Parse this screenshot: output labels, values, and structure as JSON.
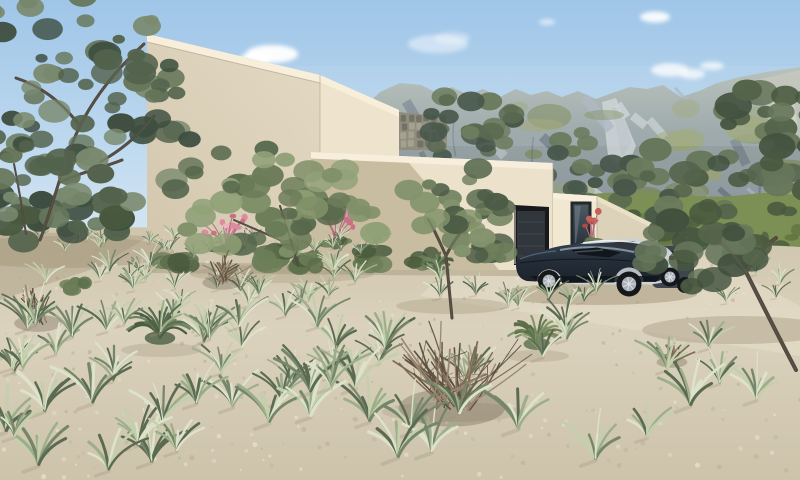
{
  "meta": {
    "type": "architectural-exterior-rendering",
    "description": "3D visualization of a modern flat-roofed beige villa on a sandy hillside with dry grasses, olive trees, two parked cars and a rocky green mountain range under a light blue sky",
    "width": 800,
    "height": 480
  },
  "palette": {
    "sky_top": "#9fc5e8",
    "sky_mid": "#bcd8ee",
    "sky_horizon": "#d9e8f4",
    "cloud": "#ffffff",
    "mtn_crest": "#b5bdb4",
    "mtn_upper": "#95a1a1",
    "mtn_base": "#87939e",
    "mtn_rock_light": "#aab3bd",
    "mtn_rock_bright": "#cdd2d3",
    "mtn_rock_shadow": "#65727f",
    "mtn_green": "#9aa26b",
    "mtn_green_dark": "#77854e",
    "foothill": "#7c8f55",
    "foothill_dark": "#5f7240",
    "scrub_dark": "#4b5e3f",
    "wall_bright": "#f1e8d2",
    "wall_lit": "#eee4ce",
    "wall_mid": "#ece2cb",
    "wall_shaded": "#c9bda1",
    "coping_light": "#f7efdc",
    "edge_dark": "#baac8e",
    "stone_base": "#8f8d7d",
    "stone_light": "#a8a594",
    "stone_dark": "#6f6d60",
    "garage_recess": "#17191c",
    "garage_door": "#30363b",
    "door_line": "#3f464c",
    "window_frame": "#24282b",
    "glass_top": "#4d5a64",
    "glass_bottom": "#2b333b",
    "glass_refl": "#72828e",
    "sand_top": "#cfc5ad",
    "sand_mid": "#dbd2bd",
    "sand_bottom": "#cdc3ab",
    "sand_speck_dark": "#bfb49a",
    "sand_speck_light": "#e9e0cb",
    "driveway_light": "#e7dfca",
    "shadow_ground": "#a1947a",
    "trunk_dark": "#4b443b",
    "trunk_light": "#6b6254",
    "twig": "#7d6c55",
    "twig_light": "#998771",
    "twig_dark": "#5e5243",
    "flower_pink": "#dc8ba0",
    "flower_pink_light": "#edb3c2",
    "flower_pink_deep": "#c96f86",
    "flower_stem": "#b2717f",
    "flower_red": "#b04a42",
    "car_navy_top": "#323f4d",
    "car_navy": "#242d38",
    "car_navy_dark": "#1b222b",
    "car_roof_hi": "#93a1ad",
    "car_glass": "#12171d",
    "sedan_silver": "#cdd2d6",
    "sedan_shade": "#a8aeb3",
    "sedan_glass": "#30373e",
    "sedan_hi": "#f1f4f6",
    "suv_dark": "#3e454c",
    "suv_glass": "#262c31",
    "tire": "#14181b",
    "rim": "#a9b0b7",
    "rim_hi": "#d9dee2",
    "taillight": "#8f4746"
  },
  "scene": {
    "sky": {
      "name": "clear-morning-sky"
    },
    "mountains": {
      "name": "rocky-green-mountain-range"
    },
    "house": {
      "style": "modern-minimalist-stacked-cubes",
      "volumes": [
        "tall-volume",
        "middle-volume",
        "garage-wing"
      ],
      "features": [
        "flat-parapet-roofs",
        "recessed-garage",
        "tall-narrow-window",
        "stone-garden-wall"
      ]
    },
    "vehicles": [
      {
        "name": "dark-blue-coupe"
      },
      {
        "name": "silver-sedan"
      },
      {
        "name": "dark-suv-rear"
      }
    ],
    "landscape": [
      "olive-trees",
      "dry-grass-tufts",
      "pink-flowering-plants",
      "dry-twig-bushes",
      "sand-gravel-ground"
    ]
  },
  "generated": {
    "stones": {
      "x0": 400,
      "y0": 114,
      "w": 46,
      "h": 34,
      "rows": 4,
      "cols": 6
    },
    "mountain": {
      "streaks": 30,
      "greens": 34,
      "ravines": 9,
      "x": [
        262,
        800
      ],
      "ystreak": [
        86,
        192
      ],
      "ygreen": [
        104,
        238
      ]
    },
    "foothill_scrub": {
      "count": 44,
      "x": [
        300,
        800
      ],
      "y": [
        210,
        248
      ]
    },
    "sand_speckles": 280,
    "shrubs": [
      {
        "cx": 175,
        "cy": 262,
        "rx": 20,
        "ry": 12
      },
      {
        "cx": 270,
        "cy": 258,
        "rx": 24,
        "ry": 14
      },
      {
        "cx": 308,
        "cy": 262,
        "rx": 17,
        "ry": 11
      },
      {
        "cx": 372,
        "cy": 258,
        "rx": 20,
        "ry": 12
      },
      {
        "cx": 424,
        "cy": 258,
        "rx": 15,
        "ry": 10
      },
      {
        "cx": 492,
        "cy": 254,
        "rx": 12,
        "ry": 8
      },
      {
        "cx": 78,
        "cy": 286,
        "rx": 14,
        "ry": 9
      }
    ],
    "shrub_colors": [
      "#5a6d4a",
      "#6c7f58",
      "#4a5b3e"
    ],
    "trees": [
      {
        "name": "shrub-band-left",
        "layer": "main",
        "clumps": 26,
        "rMin": 8,
        "rMax": 18,
        "colors": [
          "#3e4e40",
          "#52624c",
          "#66765a",
          "#49593f"
        ],
        "blobs": [
          {
            "cx": 58,
            "cy": 216,
            "rx": 88,
            "ry": 30
          }
        ],
        "branches": [],
        "branchWidth": 2
      },
      {
        "name": "olive-tree-left-edge",
        "layer": "main",
        "clumps": 20,
        "rMin": 7,
        "rMax": 15,
        "colors": [
          "#3e4e40",
          "#52624c",
          "#66765a",
          "#7a8a6e"
        ],
        "blobs": [
          {
            "cx": 14,
            "cy": 160,
            "rx": 48,
            "ry": 78
          }
        ],
        "branches": [
          "M26,234 C22,206 18,184 14,164"
        ],
        "branchWidth": 2
      },
      {
        "name": "olive-tree-top-left",
        "layer": "main",
        "clumps": 72,
        "rMin": 6,
        "rMax": 17,
        "colors": [
          "#3e4e40",
          "#52624c",
          "#66765a",
          "#7a8a6e"
        ],
        "blobs": [
          {
            "cx": 60,
            "cy": 70,
            "rx": 115,
            "ry": 100
          },
          {
            "cx": 125,
            "cy": 130,
            "rx": 75,
            "ry": 85
          }
        ],
        "branches": [
          "M40,240 C55,200 64,158 80,126",
          "M80,126 C96,94 120,66 144,44",
          "M80,126 C60,100 40,86 16,78",
          "M100,162 C122,150 140,134 154,116",
          "M60,182 C82,172 102,168 122,160"
        ],
        "branchWidth": 3
      },
      {
        "name": "olive-tree-center",
        "layer": "main",
        "clumps": 48,
        "rMin": 8,
        "rMax": 17,
        "colors": [
          "#57684c",
          "#6b7c59",
          "#7f9068",
          "#91a178"
        ],
        "blobs": [
          {
            "cx": 272,
            "cy": 188,
            "rx": 95,
            "ry": 48
          },
          {
            "cx": 248,
            "cy": 224,
            "rx": 68,
            "ry": 42
          },
          {
            "cx": 332,
            "cy": 214,
            "rx": 52,
            "ry": 42
          }
        ],
        "branches": [
          "M298,266 C292,244 286,224 280,206",
          "M280,240 C262,232 248,226 234,220"
        ],
        "branchWidth": 2
      },
      {
        "name": "olive-tree-garage",
        "layer": "main",
        "clumps": 36,
        "rMin": 7,
        "rMax": 15,
        "colors": [
          "#5a6b4f",
          "#6e7f5c",
          "#82936c",
          "#4c5c46"
        ],
        "blobs": [
          {
            "cx": 456,
            "cy": 202,
            "rx": 54,
            "ry": 40
          },
          {
            "cx": 482,
            "cy": 232,
            "rx": 36,
            "ry": 28
          }
        ],
        "branches": [
          "M452,318 C450,296 448,276 446,256",
          "M446,256 C439,240 434,229 428,219",
          "M446,256 C453,241 461,231 470,222"
        ],
        "branchWidth": 3
      },
      {
        "name": "olive-canopy-behind-parapet",
        "layer": "bg",
        "clumps": 26,
        "rMin": 7,
        "rMax": 15,
        "colors": [
          "#46564a",
          "#5a6a52",
          "#6c7c5e"
        ],
        "blobs": [
          {
            "cx": 468,
            "cy": 126,
            "rx": 50,
            "ry": 36
          }
        ],
        "branches": [],
        "branchWidth": 2
      },
      {
        "name": "olive-canopy-behind-garage",
        "layer": "bg",
        "clumps": 32,
        "rMin": 7,
        "rMax": 15,
        "colors": [
          "#46564a",
          "#58684f",
          "#6a7a5c"
        ],
        "blobs": [
          {
            "cx": 590,
            "cy": 168,
            "rx": 48,
            "ry": 36
          },
          {
            "cx": 632,
            "cy": 196,
            "rx": 40,
            "ry": 30
          }
        ],
        "branches": [],
        "branchWidth": 2
      },
      {
        "name": "olive-tree-right",
        "layer": "right",
        "clumps": 64,
        "rMin": 8,
        "rMax": 19,
        "colors": [
          "#41513e",
          "#54644b",
          "#66765a",
          "#49593f"
        ],
        "blobs": [
          {
            "cx": 738,
            "cy": 192,
            "rx": 96,
            "ry": 86
          },
          {
            "cx": 778,
            "cy": 134,
            "rx": 58,
            "ry": 52
          },
          {
            "cx": 700,
            "cy": 252,
            "rx": 58,
            "ry": 50
          }
        ],
        "branches": [
          "M796,370 C776,332 760,300 746,272",
          "M746,272 C734,254 724,244 712,236",
          "M746,272 C754,256 764,246 776,238"
        ],
        "branchWidth": 4
      }
    ],
    "spiky_plants": [
      {
        "cx": 438,
        "cy": 268,
        "r": 16,
        "blades": 16,
        "colors": [
          "#5c7050",
          "#6f8360",
          "#4a5d40"
        ],
        "layer": "base"
      },
      {
        "cx": 160,
        "cy": 338,
        "r": 34,
        "blades": 28,
        "colors": [
          "#5c7050",
          "#6f8360",
          "#4a5d40"
        ],
        "layer": "mid"
      },
      {
        "cx": 537,
        "cy": 344,
        "r": 30,
        "blades": 26,
        "colors": [
          "#6e8258",
          "#82966a",
          "#5a6e4a"
        ],
        "layer": "mid"
      }
    ],
    "flowers": [
      {
        "cx": 226,
        "cy": 242,
        "spread": 28,
        "count": 16,
        "colors": [
          "#dc8ba0",
          "#edb3c2",
          "#c96f86"
        ]
      },
      {
        "cx": 336,
        "cy": 236,
        "spread": 20,
        "count": 11,
        "colors": [
          "#dc8ba0",
          "#edb3c2",
          "#c96f86"
        ]
      },
      {
        "cx": 593,
        "cy": 236,
        "spread": 9,
        "count": 7,
        "colors": [
          "#b04a42",
          "#c6615a"
        ]
      }
    ],
    "twig_bushes": [
      {
        "cx": 222,
        "cy": 280,
        "r": 28,
        "branches": 18,
        "layer": "mid"
      },
      {
        "cx": 38,
        "cy": 320,
        "r": 34,
        "branches": 20,
        "layer": "mid"
      },
      {
        "cx": 672,
        "cy": 360,
        "r": 22,
        "branches": 14,
        "layer": "mid"
      },
      {
        "cx": 452,
        "cy": 400,
        "r": 76,
        "branches": 44,
        "layer": "center"
      }
    ],
    "grass": {
      "palette": [
        "#dde2ca",
        "#c3cfad",
        "#9cae8a",
        "#75876a",
        "#5a6b52"
      ],
      "bands": [
        {
          "y": [
            238,
            262
          ],
          "x": [
            0,
            800
          ],
          "count": 26,
          "scale": [
            0.35,
            0.55
          ],
          "layer": "far",
          "excludeCars": true
        },
        {
          "y": [
            262,
            312
          ],
          "x": [
            0,
            800
          ],
          "count": 36,
          "scale": [
            0.55,
            0.8
          ],
          "layer": "far",
          "excludeCars": true
        },
        {
          "y": [
            312,
            385
          ],
          "x": [
            0,
            800
          ],
          "count": 36,
          "scale": [
            0.85,
            1.15
          ],
          "layer": "mid2",
          "leftBias": true
        },
        {
          "y": [
            385,
            472
          ],
          "x": [
            0,
            800
          ],
          "count": 28,
          "scale": [
            1.15,
            1.65
          ],
          "layer": "near",
          "leftBias": true
        }
      ]
    }
  }
}
